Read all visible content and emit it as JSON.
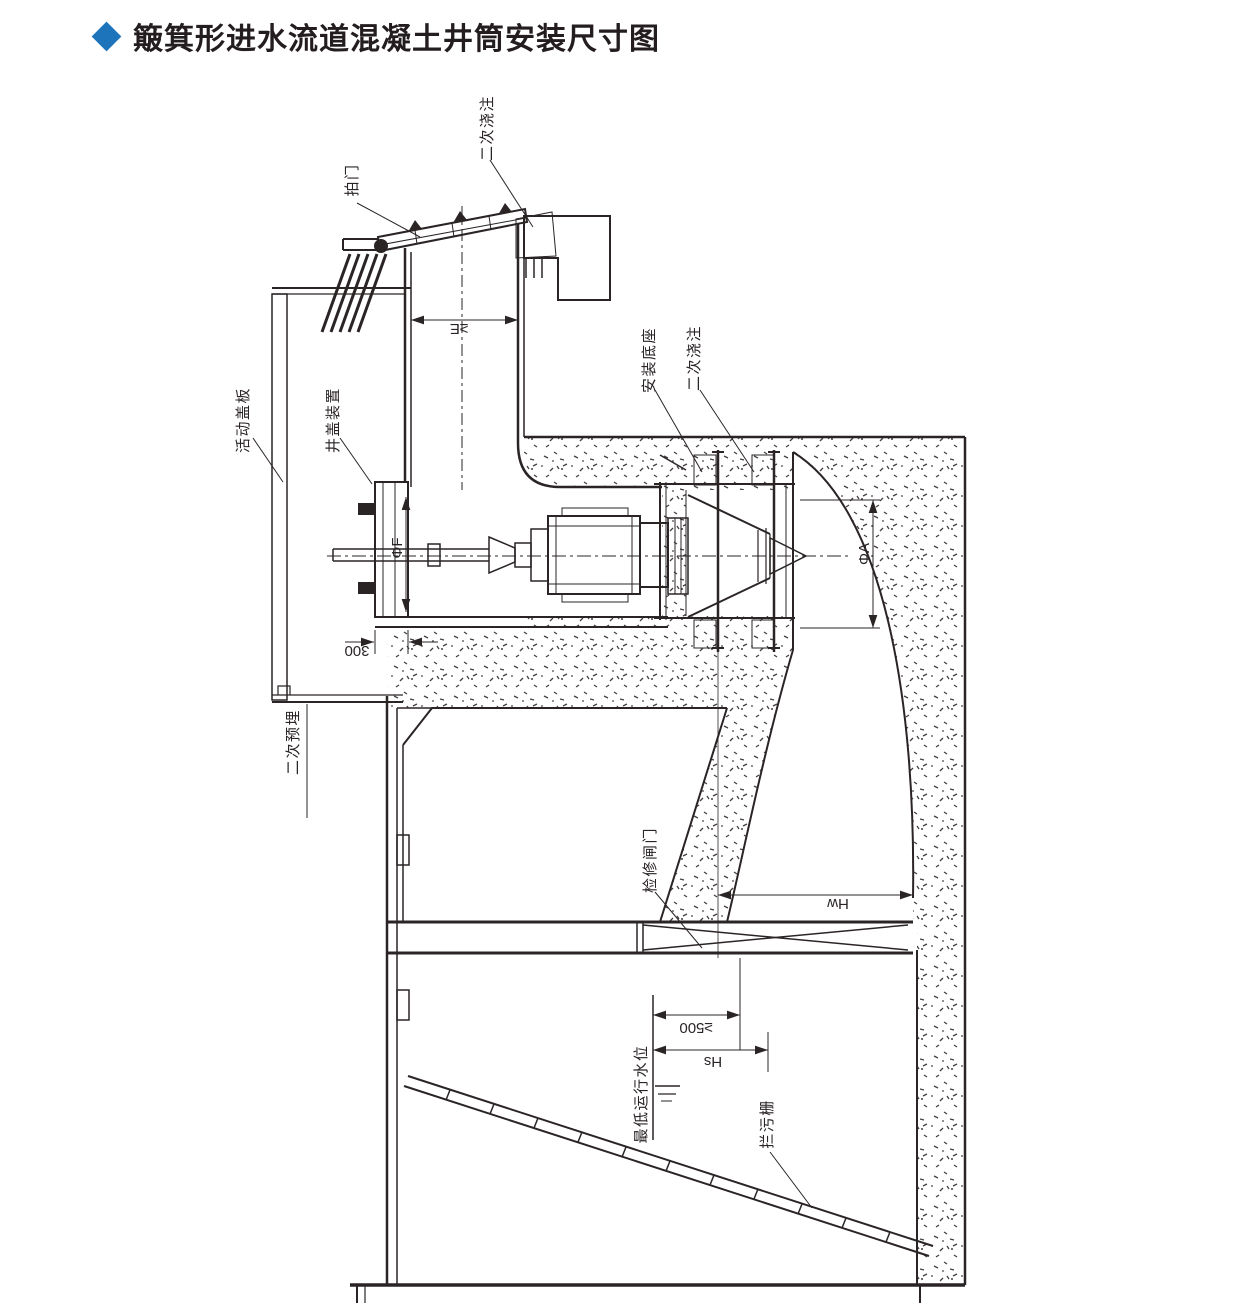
{
  "title": {
    "text": "簸箕形进水流道混凝土井筒安装尺寸图"
  },
  "colors": {
    "accent_blue": "#1d74ba",
    "line": "#2a2425",
    "background": "#ffffff"
  },
  "labels": [
    {
      "id": "flap-gate",
      "text": "拍门"
    },
    {
      "id": "secondary-pour-top",
      "text": "二次浇注"
    },
    {
      "id": "movable-cover-plate",
      "text": "活动盖板"
    },
    {
      "id": "well-cover-device",
      "text": "井盖装置"
    },
    {
      "id": "mounting-base",
      "text": "安装底座"
    },
    {
      "id": "secondary-pour-base",
      "text": "二次浇注"
    },
    {
      "id": "secondary-embedment",
      "text": "二次预埋"
    },
    {
      "id": "maintenance-gate",
      "text": "检修闸门"
    },
    {
      "id": "lowest-water-level",
      "text": "最低运行水位"
    },
    {
      "id": "trash-rack",
      "text": "拦污栅"
    }
  ],
  "dimensions": {
    "channel_width": {
      "text": "≥E"
    },
    "flange_dia": {
      "text": "ΦF"
    },
    "bell_dia": {
      "text": "ΦA"
    },
    "cover_gap": {
      "text": "300"
    },
    "hw": {
      "text": "Hw"
    },
    "min_clearance": {
      "text": "≥500"
    },
    "hs": {
      "text": "Hs"
    }
  }
}
